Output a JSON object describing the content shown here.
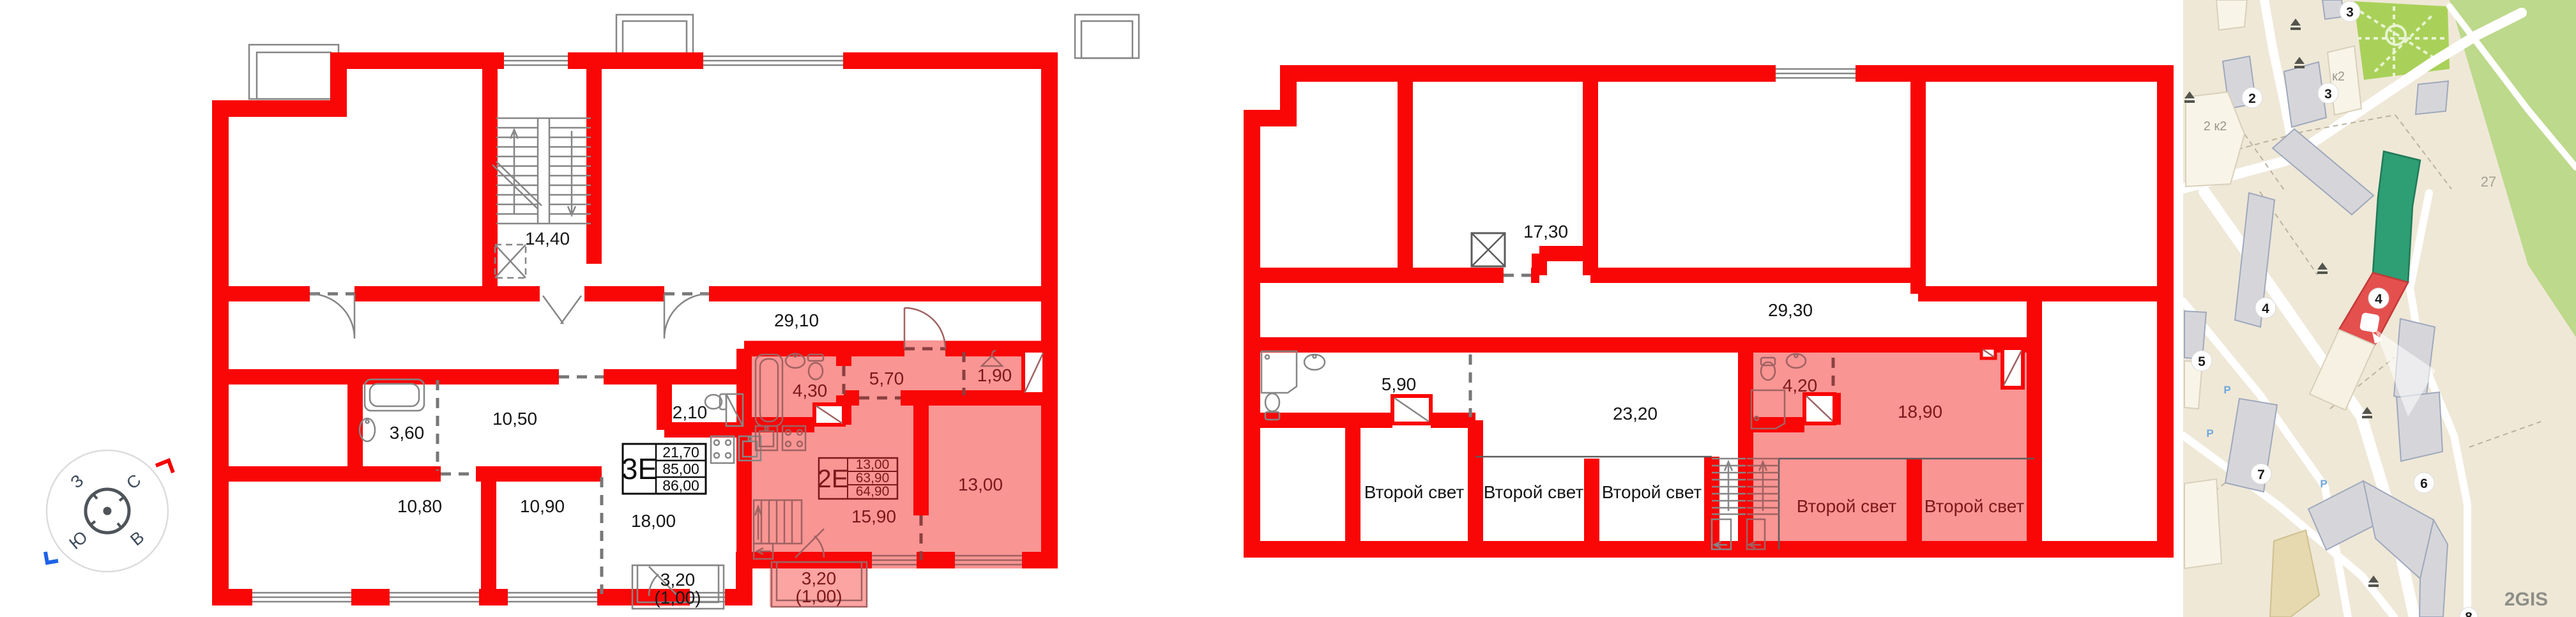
{
  "compass": {
    "north": "С",
    "east": "В",
    "south": "Ю",
    "west": "З"
  },
  "plan_left": {
    "apartment3": {
      "code": "3Е",
      "area_top": "21,70",
      "area_mid": "85,00",
      "area_bot": "86,00"
    },
    "apartment2": {
      "code": "2Е",
      "area_top": "13,00",
      "area_mid": "63,90",
      "area_bot": "64,90"
    },
    "rooms": {
      "stair_hall": "14,40",
      "corridor": "29,10",
      "bathroom": "3,60",
      "hallway": "10,50",
      "wc": "2,10",
      "bedroom1": "10,80",
      "bedroom2": "10,90",
      "kitchen_living": "18,00",
      "pink_bathroom": "4,30",
      "pink_hall": "5,70",
      "pink_wardrobe": "1,90",
      "pink_bedroom": "13,00",
      "pink_kitchen_living": "15,90"
    },
    "balcony1_line1": "3,20",
    "balcony1_line2": "(1,00)",
    "balcony2_line1": "3,20",
    "balcony2_line2": "(1,00)"
  },
  "plan_right": {
    "rooms": {
      "stair_hall": "17,30",
      "corridor": "29,30",
      "bathroom": "5,90",
      "living": "23,20",
      "void1": "Второй свет",
      "void2": "Второй свет",
      "void3": "Второй свет",
      "pink_bathroom": "4,20",
      "pink_living": "18,90",
      "pink_void1": "Второй свет",
      "pink_void2": "Второй свет"
    }
  },
  "map": {
    "badges": [
      "3",
      "2",
      "3",
      "4",
      "4",
      "5",
      "7",
      "6",
      "8"
    ],
    "labels": {
      "building_2k2": "2 к2",
      "building_k2": "к2",
      "parcel": "27",
      "watermark": "2GIS",
      "parking": "P"
    }
  }
}
